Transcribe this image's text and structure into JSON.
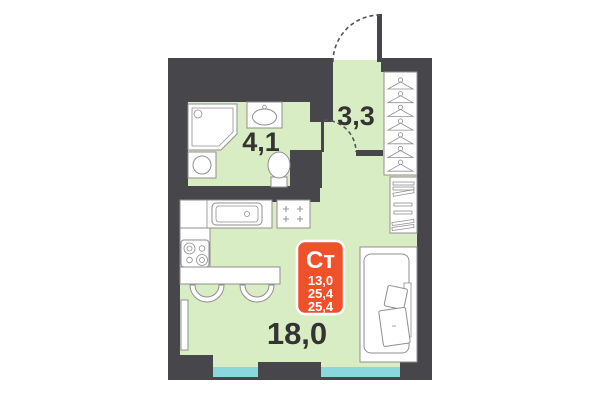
{
  "plan": {
    "title": "studio-floor-plan",
    "unit_badge": {
      "type": "Ст",
      "line1": "13,0",
      "line2": "25,4",
      "line3": "25,4"
    },
    "rooms": {
      "hallway": {
        "area": "3,3"
      },
      "bathroom": {
        "area": "4,1"
      },
      "main": {
        "area": "18,0"
      }
    },
    "icons": {
      "shower": "corner-shower-icon",
      "bath_sink": "sink-icon",
      "washer": "washing-machine-icon",
      "toilet": "toilet-icon",
      "hangers": "hanger-icon",
      "shoe_rack": "shelf-rack-icon",
      "kitchen_sink": "kitchen-sink-icon",
      "hob": "hob-icon",
      "stove": "stove-icon",
      "bar": "bar-counter-icon",
      "chair": "chair-icon",
      "radiator": "radiator-icon",
      "bed": "bed-icon",
      "entrance_door": "door-swing-icon",
      "bathroom_door": "door-swing-icon",
      "window": "window-glazing"
    },
    "colors": {
      "wall": "#47474B",
      "floor": "#D9EDC5",
      "window": "#8BD7DE",
      "badge": "#F1512A",
      "badge_text": "#FFFFFF",
      "label_text": "#333333",
      "furniture_stroke": "#8F8F8F"
    }
  }
}
